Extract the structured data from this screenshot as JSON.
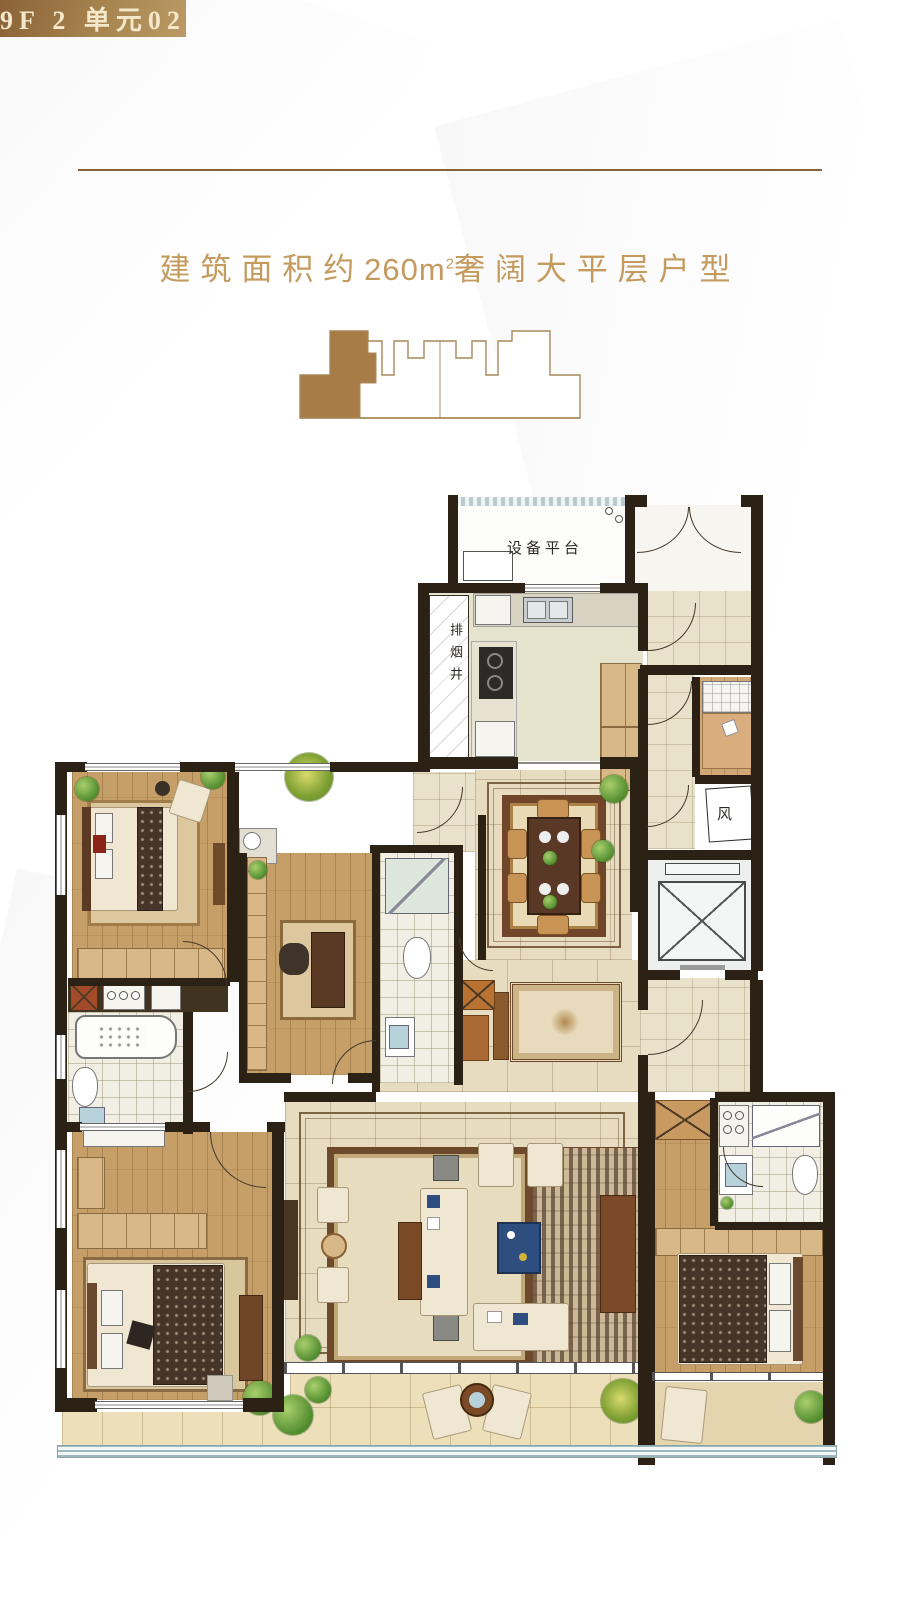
{
  "header": {
    "banner_label": "9F 2 单元02"
  },
  "subtitle": {
    "prefix": "建筑面积约",
    "number": "260",
    "unit_base": "m",
    "unit_sup": "2",
    "suffix": "奢阔大平层户型"
  },
  "floorplan": {
    "labels": {
      "equipment_platform": "设备平台",
      "smoke_exhaust_shaft": "排烟井",
      "wind_shaft": "风"
    }
  },
  "colors": {
    "gold_text": "#c49a5e",
    "banner_dark": "#8a6237",
    "banner_mid": "#a8854f",
    "banner_light": "#bb9a66",
    "banner_text": "#f4e8cb",
    "keyplan_outline": "#a8895c",
    "keyplan_fill": "#a87c46",
    "wall": "#2b2115",
    "wood": "#c69e68",
    "tile": "#e9e2cb",
    "marble": "#e7dcc0",
    "bath": "#f1eee3",
    "accent_blue": "#2d4e7e",
    "railing": "#9db9be"
  }
}
